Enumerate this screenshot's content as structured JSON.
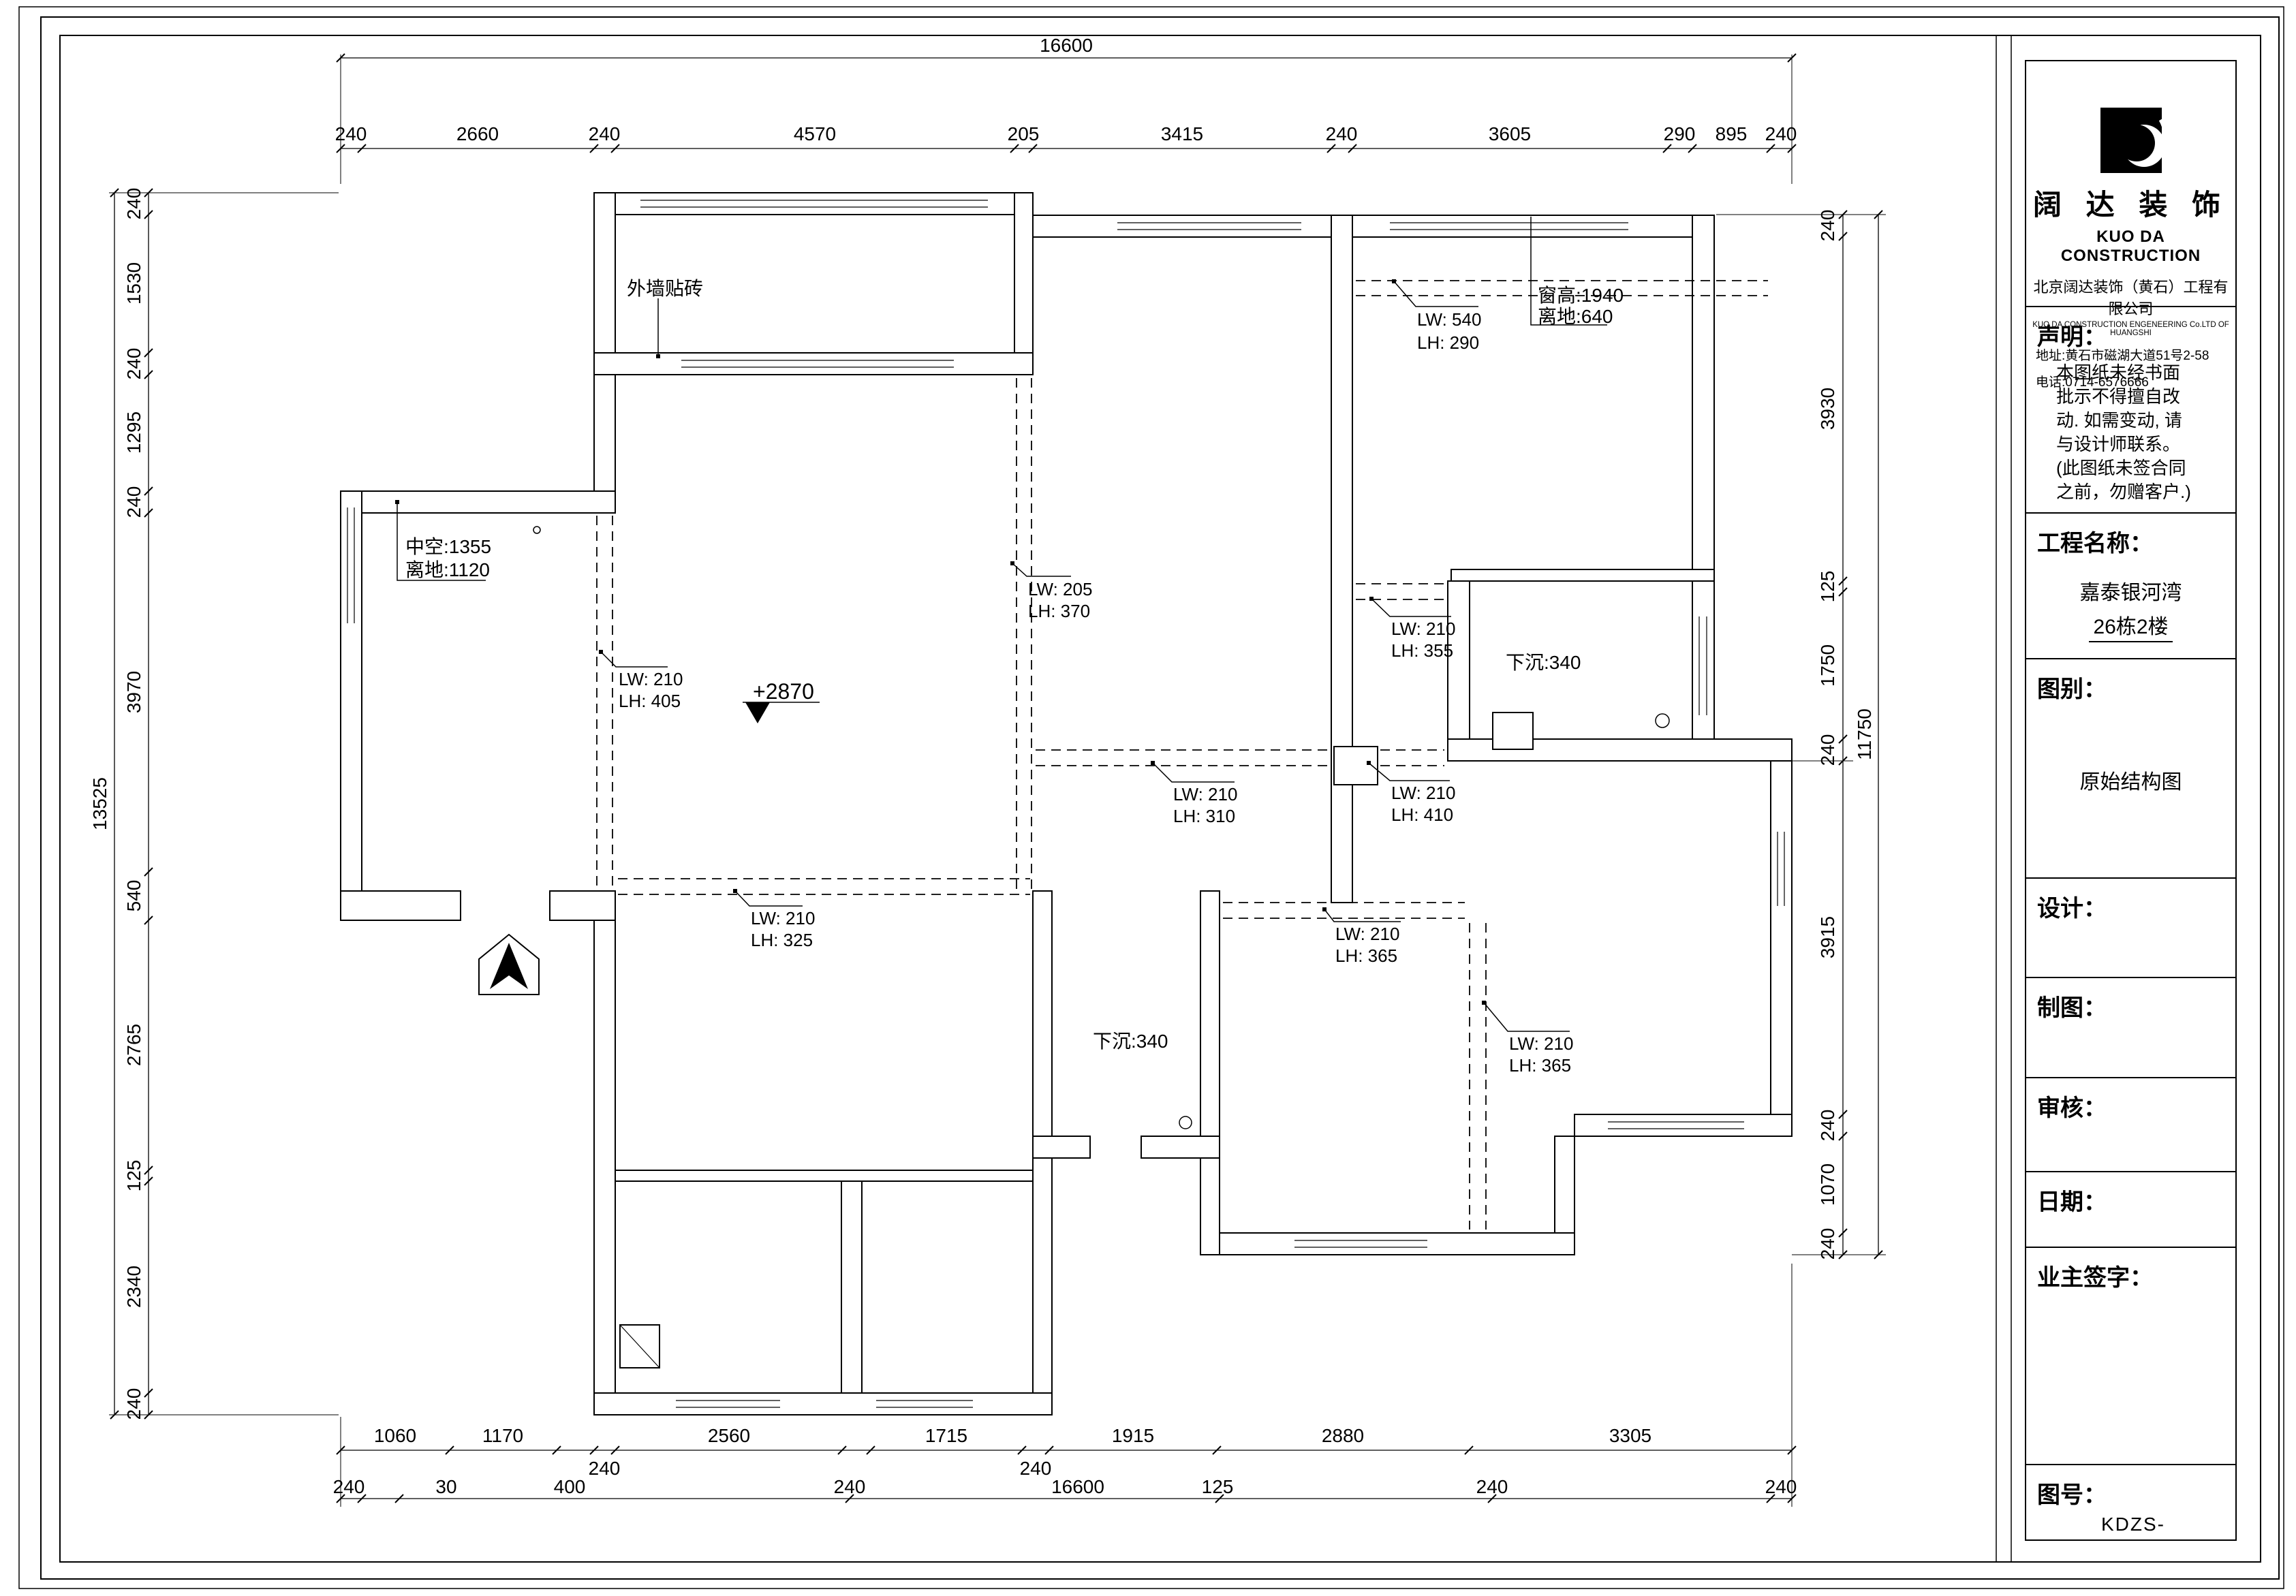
{
  "colors": {
    "ink": "#000000",
    "paper": "#ffffff"
  },
  "sheet": {
    "company": {
      "name_cn": "阔 达 装 饰",
      "name_en": "KUO DA CONSTRUCTION",
      "company_cn": "北京阔达装饰（黄石）工程有限公司",
      "company_en": "KUO DA CONSTRUCTION ENGENEERING Co.LTD OF HUANGSHI",
      "address": "地址:黄石市磁湖大道51号2-58",
      "phone": "电话:0714-6576666"
    },
    "statement": {
      "header": "声明：",
      "lines": [
        "本图纸未经书面",
        "批示不得擅自改",
        "动. 如需变动, 请",
        "与设计师联系。",
        "(此图纸未签合同",
        "之前，勿赠客户.)"
      ]
    },
    "project": {
      "header": "工程名称：",
      "name": "嘉泰银河湾",
      "building": "26栋2楼"
    },
    "drawing_type": {
      "header": "图别：",
      "value": "原始结构图"
    },
    "design_label": "设计：",
    "draft_label": "制图：",
    "review_label": "审核：",
    "date_label": "日期：",
    "owner_label": "业主签字：",
    "drawing_no": {
      "header": "图号：",
      "value": "KDZS-"
    }
  },
  "plan": {
    "annotations": {
      "ext_wall": "外墙贴砖",
      "bay": [
        "中空:1355",
        "离地:1120"
      ],
      "win_high": [
        "窗高:1940",
        "离地:640"
      ],
      "elev": "+2870",
      "sunken1": "下沉:340",
      "sunken2": "下沉:340",
      "beams": [
        [
          "LW: 540",
          "LH: 290"
        ],
        [
          "LW: 205",
          "LH: 370"
        ],
        [
          "LW: 210",
          "LH: 405"
        ],
        [
          "LW: 210",
          "LH: 355"
        ],
        [
          "LW: 210",
          "LH: 310"
        ],
        [
          "LW: 210",
          "LH: 410"
        ],
        [
          "LW: 210",
          "LH: 325"
        ],
        [
          "LW: 210",
          "LH: 365"
        ],
        [
          "LW: 210",
          "LH: 365"
        ]
      ]
    },
    "dims": {
      "top_total": "16600",
      "top": [
        "240",
        "2660",
        "240",
        "4570",
        "205",
        "3415",
        "240",
        "3605",
        "290",
        "895",
        "240"
      ],
      "left_total": "13525",
      "left": [
        "240",
        "1530",
        "240",
        "1295",
        "240",
        "3970",
        "540",
        "2765",
        "125",
        "2340",
        "240"
      ],
      "right_total": "11750",
      "right": [
        "240",
        "3930",
        "125",
        "1750",
        "240",
        "3915",
        "240",
        "1070",
        "240"
      ],
      "bottom1": [
        "1060",
        "1170",
        "2560",
        "1715",
        "1915",
        "2880",
        "3305"
      ],
      "bottom1b": [
        "240",
        "240"
      ],
      "bottom2": [
        "240",
        "30",
        "400",
        "240",
        "16600",
        "125",
        "240",
        "240"
      ]
    }
  }
}
